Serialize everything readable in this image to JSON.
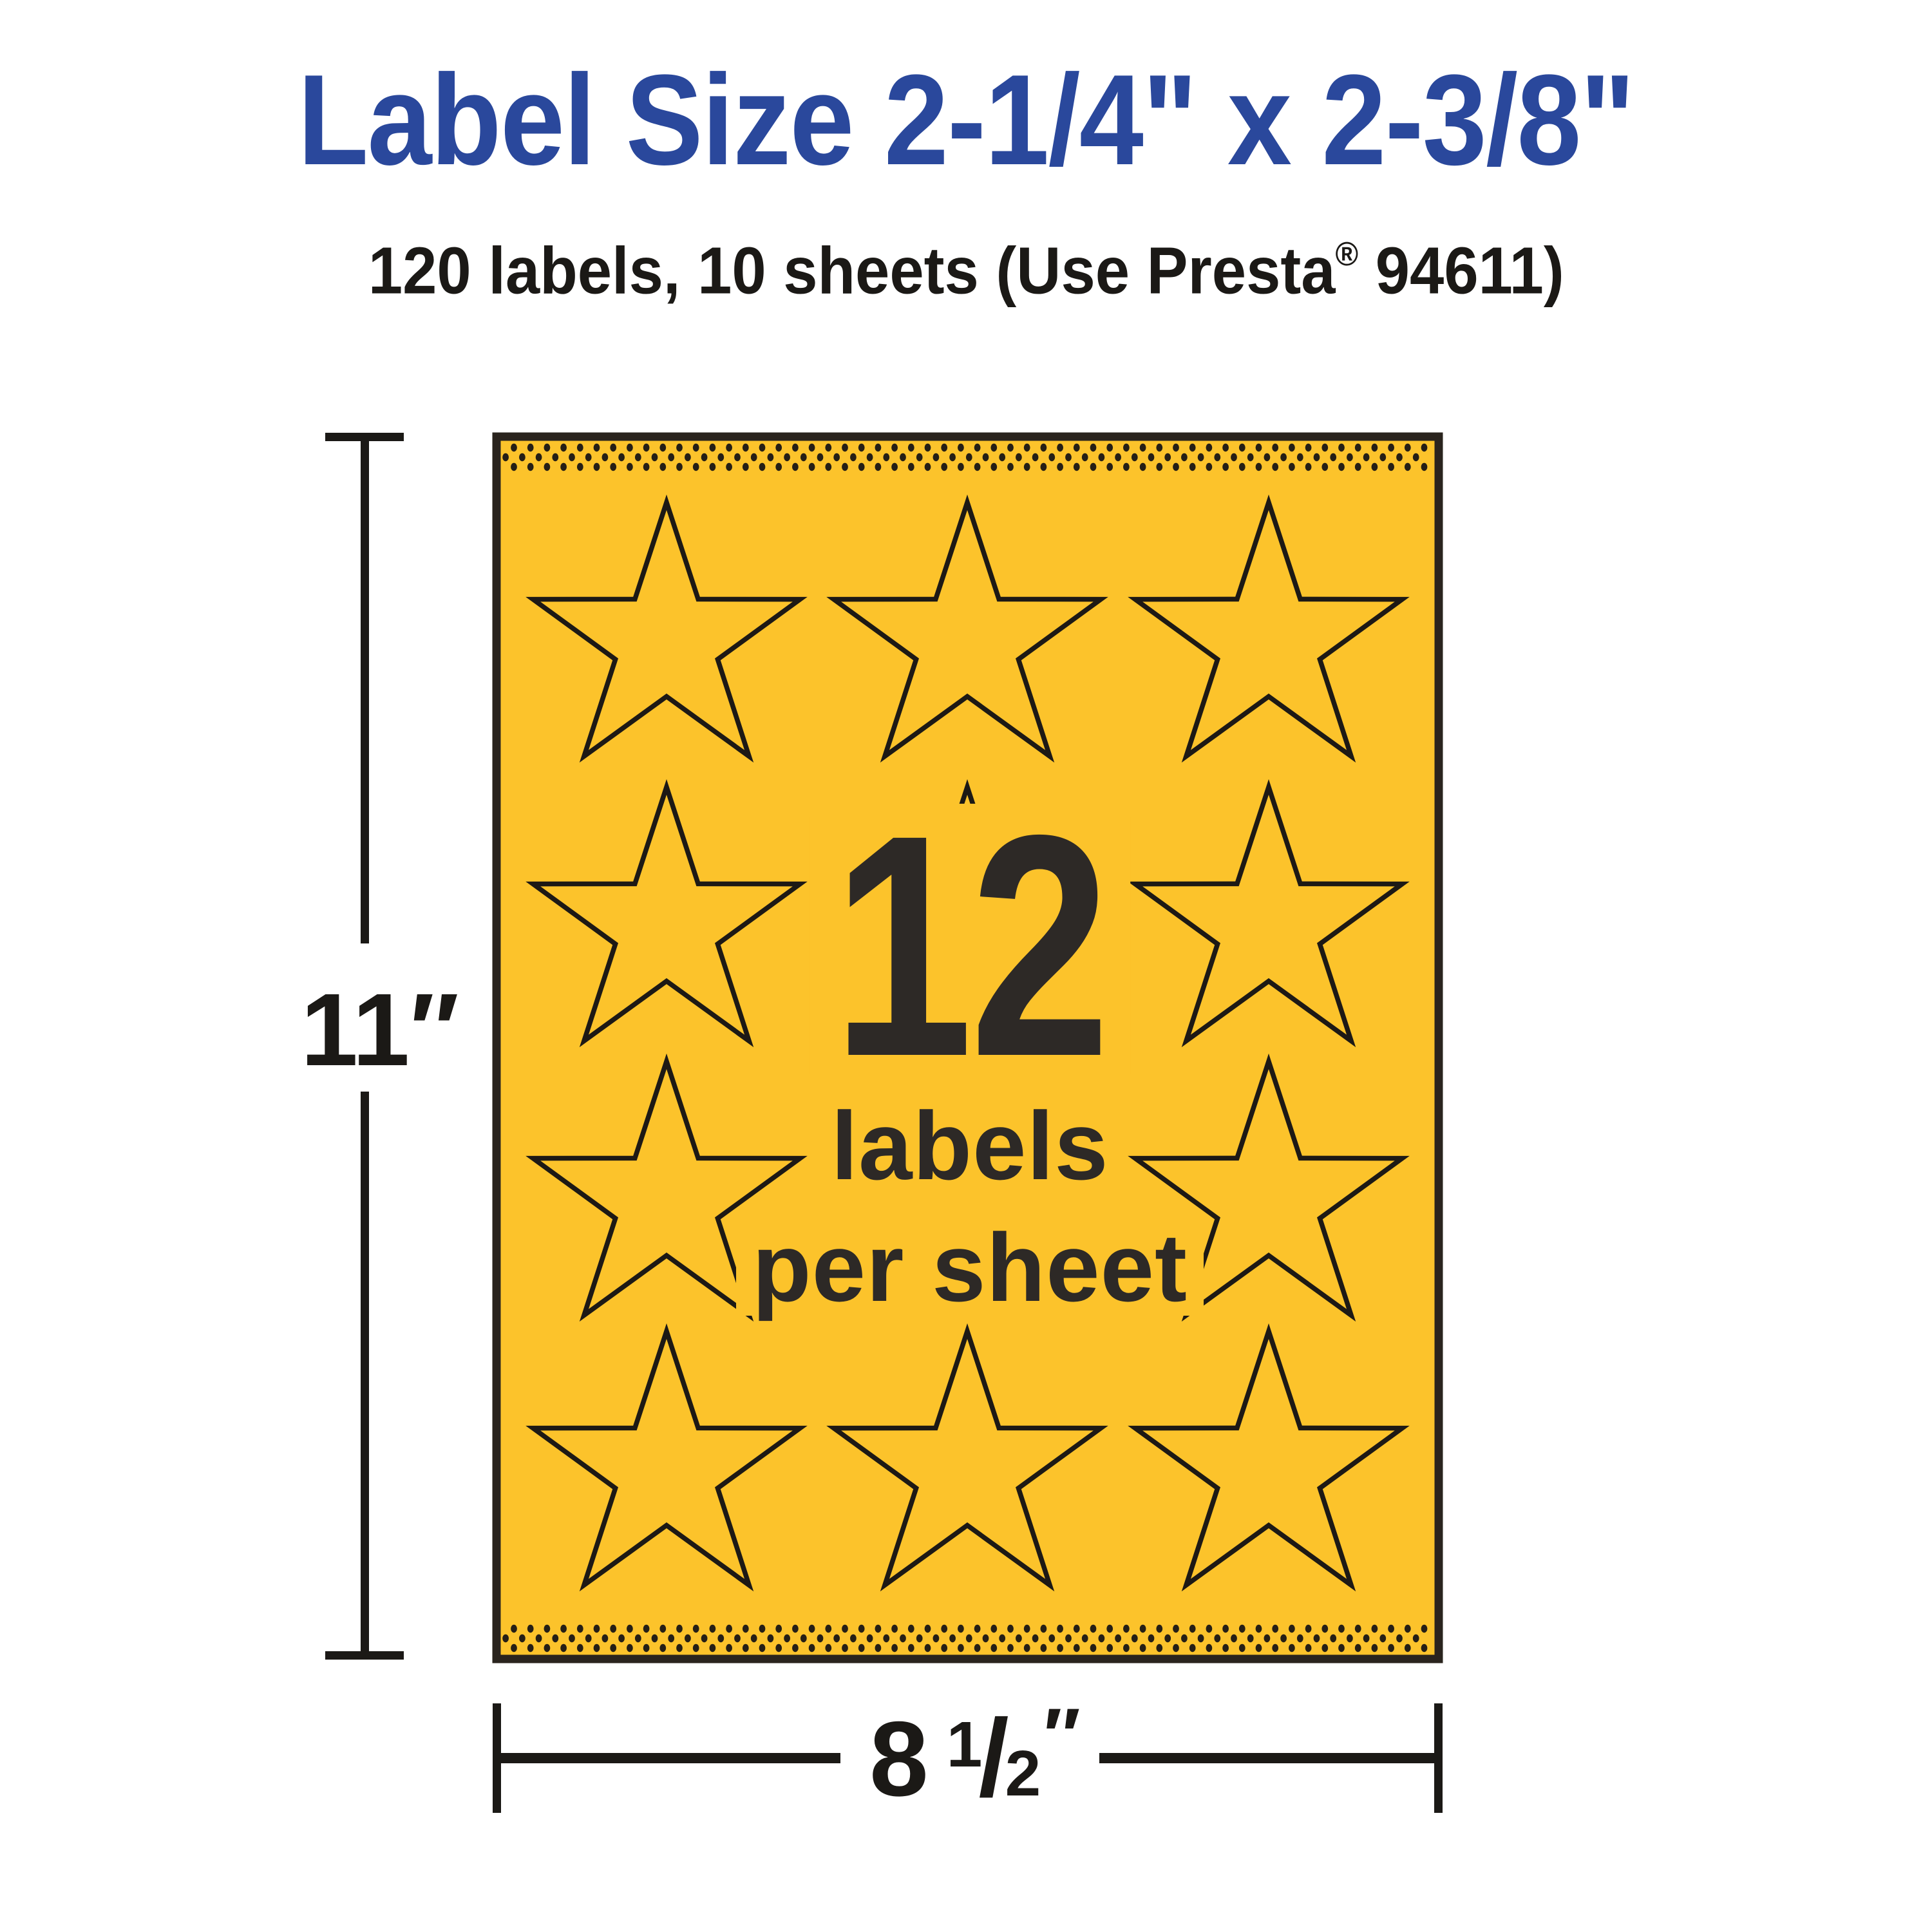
{
  "title": {
    "text": "Label Size 2-1/4\" x 2-3/8\"",
    "color": "#2A489C"
  },
  "subtitle": {
    "part1": "120 labels, 10 sheets (Use Presta",
    "registered_mark": "®",
    "part2": " 94611)",
    "color": "#1B1916"
  },
  "sheet": {
    "background_color": "#FCC32B",
    "border_color": "#2A241E",
    "star_outline_color": "#1D1915",
    "perforation_dot_color": "#251F16",
    "text_color": "#2D2926",
    "star_count": 12,
    "count_label": "12",
    "per_sheet_line1": "labels",
    "per_sheet_line2": "per sheet"
  },
  "dimensions": {
    "height_label": "11″",
    "width_whole": "8",
    "width_numerator": "1",
    "width_slash": "/",
    "width_denominator": "2",
    "width_unit": "″",
    "line_color": "#1B1916"
  }
}
